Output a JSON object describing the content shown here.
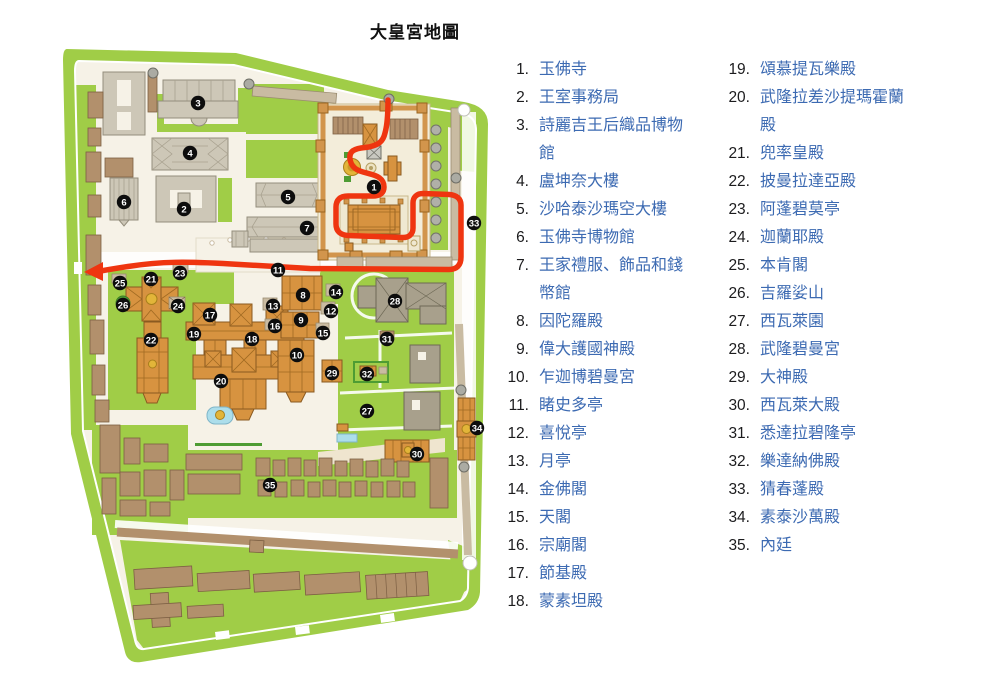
{
  "title": "大皇宮地圖",
  "legend": {
    "column1": [
      {
        "num": "1.",
        "label": "玉佛寺"
      },
      {
        "num": "2.",
        "label": "王室事務局"
      },
      {
        "num": "3.",
        "label": "詩麗吉王后織品博物館"
      },
      {
        "num": "4.",
        "label": "盧坤奈大樓"
      },
      {
        "num": "5.",
        "label": "沙哈泰沙瑪空大樓"
      },
      {
        "num": "6.",
        "label": "玉佛寺博物館"
      },
      {
        "num": "7.",
        "label": "王家禮服、飾品和錢幣館"
      },
      {
        "num": "8.",
        "label": "因陀羅殿"
      },
      {
        "num": "9.",
        "label": "偉大護國神殿"
      },
      {
        "num": "10.",
        "label": "乍迦博碧曼宮"
      },
      {
        "num": "11.",
        "label": "睹史多亭"
      },
      {
        "num": "12.",
        "label": "喜悅亭"
      },
      {
        "num": "13.",
        "label": "月亭"
      },
      {
        "num": "14.",
        "label": "金佛閣"
      },
      {
        "num": "15.",
        "label": "天閣"
      },
      {
        "num": "16.",
        "label": "宗廟閣"
      },
      {
        "num": "17.",
        "label": "節基殿"
      },
      {
        "num": "18.",
        "label": "蒙素坦殿"
      }
    ],
    "column2": [
      {
        "num": "19.",
        "label": "頌慕提瓦樂殿"
      },
      {
        "num": "20.",
        "label": "武隆拉差沙提瑪霍蘭殿"
      },
      {
        "num": "21.",
        "label": "兜率皇殿"
      },
      {
        "num": "22.",
        "label": "披曼拉達亞殿"
      },
      {
        "num": "23.",
        "label": "阿蓬碧莫亭"
      },
      {
        "num": "24.",
        "label": "迦蘭耶殿"
      },
      {
        "num": "25.",
        "label": "本肯閣"
      },
      {
        "num": "26.",
        "label": "吉羅娑山"
      },
      {
        "num": "27.",
        "label": "西瓦萊園"
      },
      {
        "num": "28.",
        "label": "武隆碧曼宮"
      },
      {
        "num": "29.",
        "label": "大神殿"
      },
      {
        "num": "30.",
        "label": "西瓦萊大殿"
      },
      {
        "num": "31.",
        "label": "悉達拉碧隆亭"
      },
      {
        "num": "32.",
        "label": "樂達納佛殿"
      },
      {
        "num": "33.",
        "label": "猜春蓬殿"
      },
      {
        "num": "34.",
        "label": "素泰沙萬殿"
      },
      {
        "num": "35.",
        "label": "內廷"
      }
    ]
  },
  "map": {
    "route_color": "#EF3510",
    "colors": {
      "grass": "#A0CD47",
      "ground": "#F6F2E7",
      "building_gray": "#CDC7B7",
      "building_brown": "#B2906C",
      "building_orange": "#D79340",
      "building_olive": "#A8A08C",
      "gold": "#E2B539",
      "marker": "#0d0d0d",
      "legend_link": "#3c6ab2"
    },
    "markers": [
      {
        "n": 1,
        "x": 374,
        "y": 187
      },
      {
        "n": 2,
        "x": 184,
        "y": 209
      },
      {
        "n": 3,
        "x": 198,
        "y": 103
      },
      {
        "n": 4,
        "x": 190,
        "y": 153
      },
      {
        "n": 5,
        "x": 288,
        "y": 197
      },
      {
        "n": 6,
        "x": 124,
        "y": 202
      },
      {
        "n": 7,
        "x": 307,
        "y": 228
      },
      {
        "n": 8,
        "x": 303,
        "y": 295
      },
      {
        "n": 9,
        "x": 301,
        "y": 320
      },
      {
        "n": 10,
        "x": 297,
        "y": 355
      },
      {
        "n": 11,
        "x": 278,
        "y": 270
      },
      {
        "n": 12,
        "x": 331,
        "y": 311
      },
      {
        "n": 13,
        "x": 273,
        "y": 306
      },
      {
        "n": 14,
        "x": 336,
        "y": 292
      },
      {
        "n": 15,
        "x": 323,
        "y": 333
      },
      {
        "n": 16,
        "x": 275,
        "y": 326
      },
      {
        "n": 17,
        "x": 210,
        "y": 315
      },
      {
        "n": 18,
        "x": 252,
        "y": 339
      },
      {
        "n": 19,
        "x": 194,
        "y": 334
      },
      {
        "n": 20,
        "x": 221,
        "y": 381
      },
      {
        "n": 21,
        "x": 151,
        "y": 279
      },
      {
        "n": 22,
        "x": 151,
        "y": 340
      },
      {
        "n": 23,
        "x": 180,
        "y": 273
      },
      {
        "n": 24,
        "x": 178,
        "y": 306
      },
      {
        "n": 25,
        "x": 120,
        "y": 283
      },
      {
        "n": 26,
        "x": 123,
        "y": 305
      },
      {
        "n": 27,
        "x": 367,
        "y": 411
      },
      {
        "n": 28,
        "x": 395,
        "y": 301
      },
      {
        "n": 29,
        "x": 332,
        "y": 373
      },
      {
        "n": 30,
        "x": 417,
        "y": 454
      },
      {
        "n": 31,
        "x": 387,
        "y": 339
      },
      {
        "n": 32,
        "x": 367,
        "y": 374
      },
      {
        "n": 33,
        "x": 474,
        "y": 223
      },
      {
        "n": 34,
        "x": 477,
        "y": 428
      },
      {
        "n": 35,
        "x": 270,
        "y": 485
      }
    ]
  }
}
